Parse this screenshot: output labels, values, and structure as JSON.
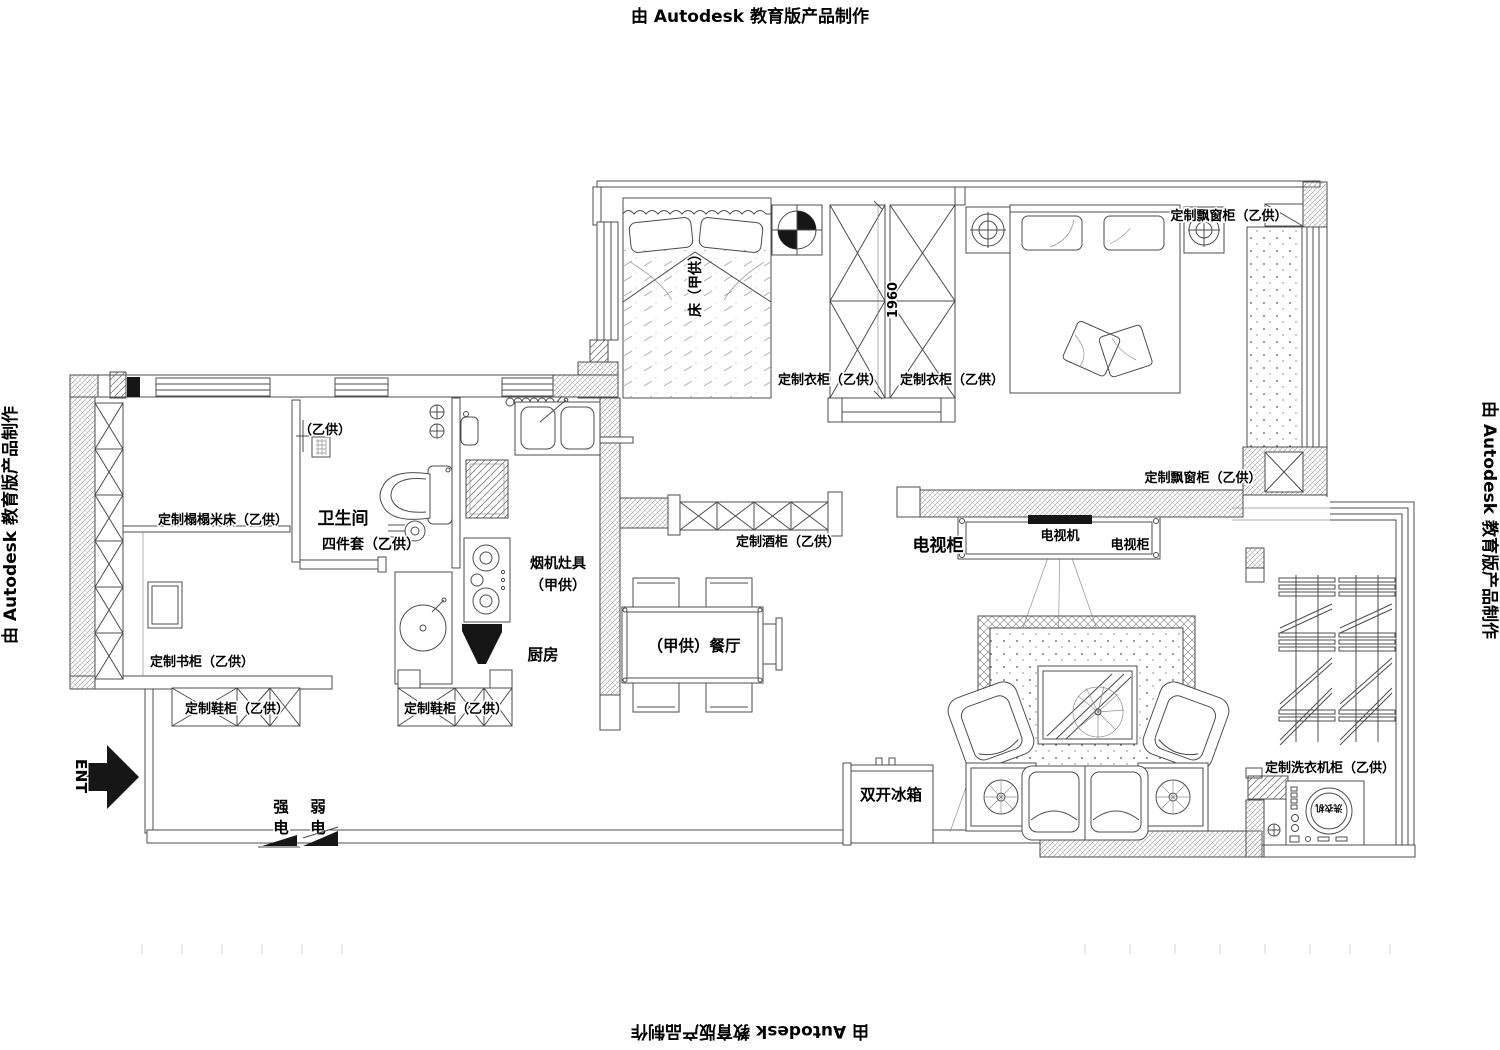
{
  "watermark": {
    "text": "由 Autodesk 教育版产品制作"
  },
  "labels": {
    "tatami_bed": "定制榻榻米床（乙供）",
    "bookcase": "定制书柜（乙供）",
    "shoe_cabinet_left": "定制鞋柜（乙供）",
    "shoe_cabinet_right": "定制鞋柜（乙供）",
    "bathroom": "卫生间",
    "bathroom_set": "四件套（乙供）",
    "bathroom_supply": "（乙供）",
    "kitchen": "厨房",
    "kitchen_hood_line1": "烟机灶具",
    "kitchen_hood_line2": "（甲供）",
    "dining": "（甲供）餐厅",
    "bed_room2": "床（甲供）",
    "dim_1960": "1960",
    "wardrobe_1": "定制衣柜（乙供）",
    "wardrobe_2": "定制衣柜（乙供）",
    "bay_window_top": "定制飘窗柜（乙供）",
    "bay_window_mid": "定制飘窗柜（乙供）",
    "wine_cabinet": "定制酒柜（乙供）",
    "tv_cabinet_main": "电视柜",
    "tv_set": "电视机",
    "tv_cabinet_side": "电视柜",
    "fridge": "双开冰箱",
    "laundry_cabinet": "定制洗衣机柜（乙供）",
    "washer": "洗衣机",
    "entrance": "ENT",
    "power_strong_top": "强",
    "power_strong_bottom": "电",
    "power_weak_top": "弱",
    "power_weak_bottom": "电"
  },
  "colors": {
    "ink": "#4c4c4c",
    "text": "#000000",
    "background": "#ffffff"
  }
}
